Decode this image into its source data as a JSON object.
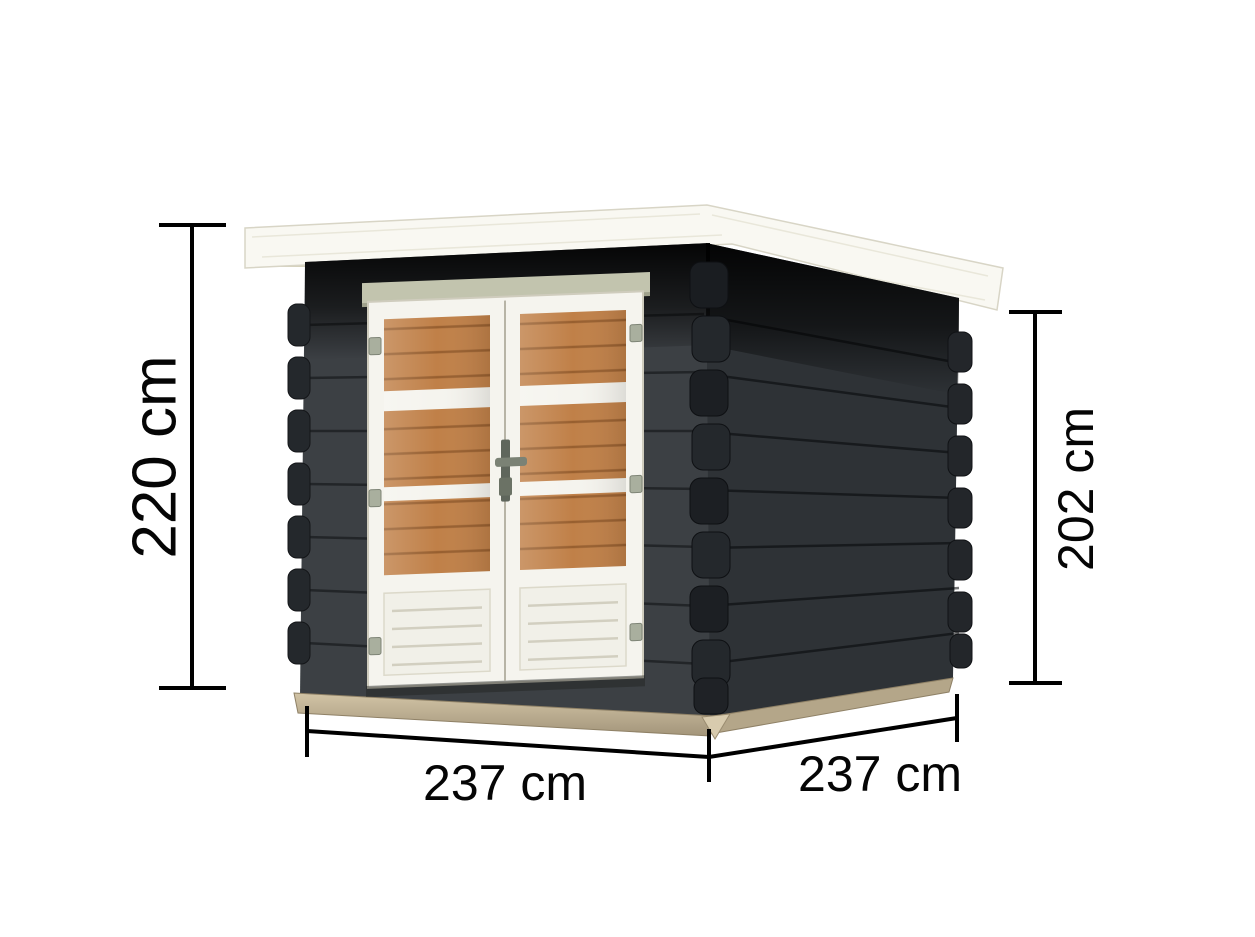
{
  "diagram": {
    "title": "Garden shed dimension diagram",
    "labels": {
      "height_total": "220 cm",
      "height_wall": "202 cm",
      "width_front": "237 cm",
      "depth_side": "237 cm"
    },
    "colors": {
      "background": "#ffffff",
      "dimension_line": "#000000",
      "roof": "#f9f8f2",
      "roof_underside": "#d6d2bb",
      "wall_front": "#3c4044",
      "wall_side": "#2e3236",
      "door": "#f5f4ee",
      "door_trim": "#c2c4ae",
      "window": "#c08048",
      "base": "#c3b395",
      "handle": "#5f665c"
    }
  }
}
